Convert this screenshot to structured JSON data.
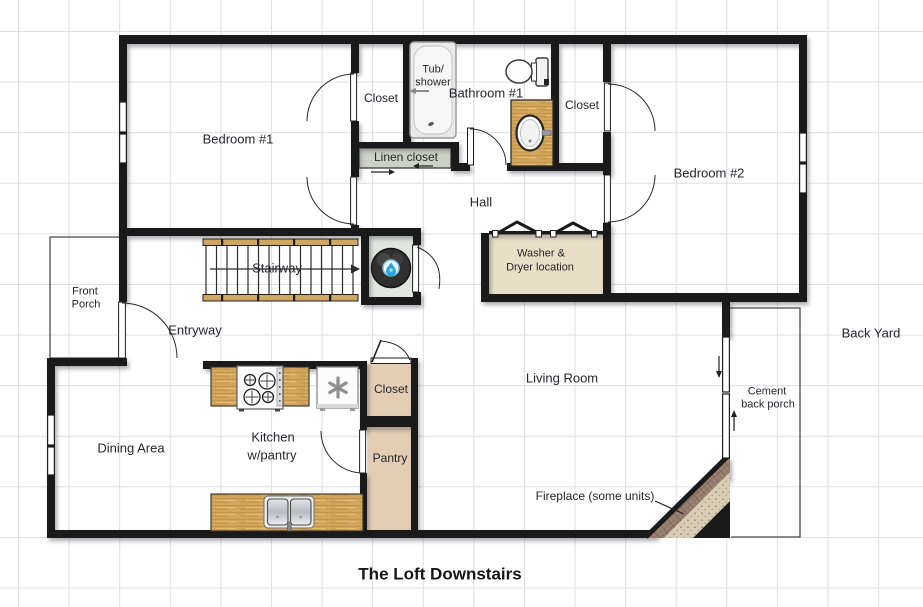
{
  "title": "The Loft Downstairs",
  "labels": {
    "bedroom1": "Bedroom #1",
    "closet_top_left": "Closet",
    "tub_line1": "Tub/",
    "tub_line2": "shower",
    "bathroom1": "Bathroom #1",
    "closet_top_right": "Closet",
    "bedroom2": "Bedroom #2",
    "linen_closet": "Linen closet",
    "hall": "Hall",
    "stairway": "Stairway",
    "washer_line1": "Washer &",
    "washer_line2": "Dryer location",
    "front_porch_line1": "Front",
    "front_porch_line2": "Porch",
    "entryway": "Entryway",
    "living_room": "Living Room",
    "back_yard": "Back Yard",
    "cement_line1": "Cement",
    "cement_line2": "back porch",
    "kitchen_line1": "Kitchen",
    "kitchen_line2": "w/pantry",
    "closet_kitchen": "Closet",
    "pantry": "Pantry",
    "dining_area": "Dining Area",
    "fireplace": "Fireplace (some units)",
    "title": "The Loft Downstairs"
  },
  "colors": {
    "wall": "#1a1a1a",
    "grid_line": "#dcdee3",
    "wood_counter": "#d2a65c",
    "washer_room_fill": "#e9dfc7",
    "closet_tan_fill": "#e3cdb4",
    "linen_green_fill": "#cbd2c2",
    "water_heater_closet_fill": "#e1e7df",
    "water_heater_blue": "#2fa3dc",
    "fireplace_brick": "#9d8170",
    "fireplace_speckle": "#d9ccb6",
    "label_text": "#26262c"
  },
  "fixtures": [
    "tub-shower-icon",
    "toilet-icon",
    "sink-vanity-icon",
    "water-heater-icon",
    "stove-icon",
    "refrigerator-asterisk-icon",
    "kitchen-sink-icon",
    "stairway-with-direction-arrow",
    "bifold-doors",
    "sliding-glass-door",
    "fireplace-corner",
    "hinged-doors",
    "windows"
  ]
}
